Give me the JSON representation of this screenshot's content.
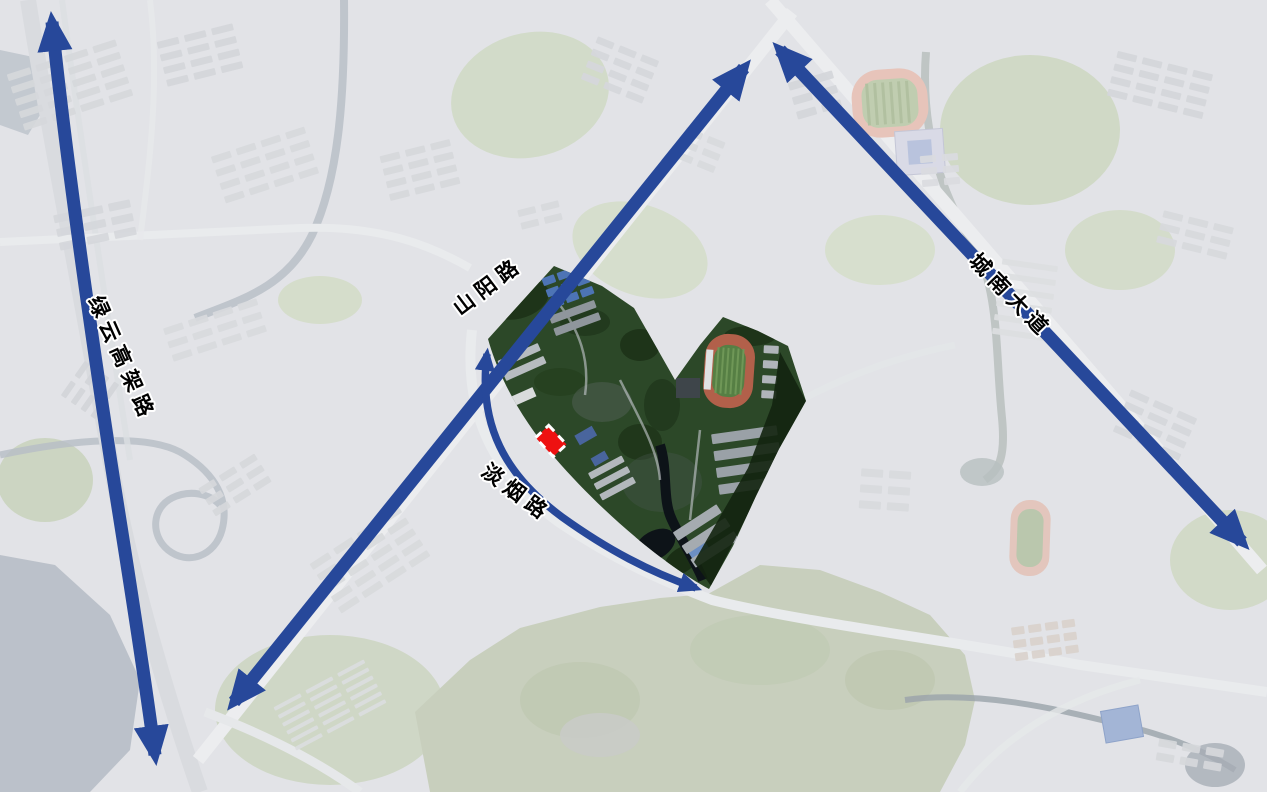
{
  "roads": {
    "lvyun": {
      "label": "绿云高架路"
    },
    "shanyang": {
      "label": "山阳路"
    },
    "chengnan": {
      "label": "城南大道"
    },
    "danyan": {
      "label": "淡烟路"
    }
  },
  "marker": {
    "color": "#ee1111",
    "border_color": "#ffffff"
  },
  "colors": {
    "arrow_blue": "#27489a",
    "label_text": "#000000",
    "label_halo": "#ffffff",
    "campus_green": "#2c4828",
    "track_orange": "#b2604a",
    "track_field_green": "#567f44",
    "background": "#e2e3e7"
  }
}
